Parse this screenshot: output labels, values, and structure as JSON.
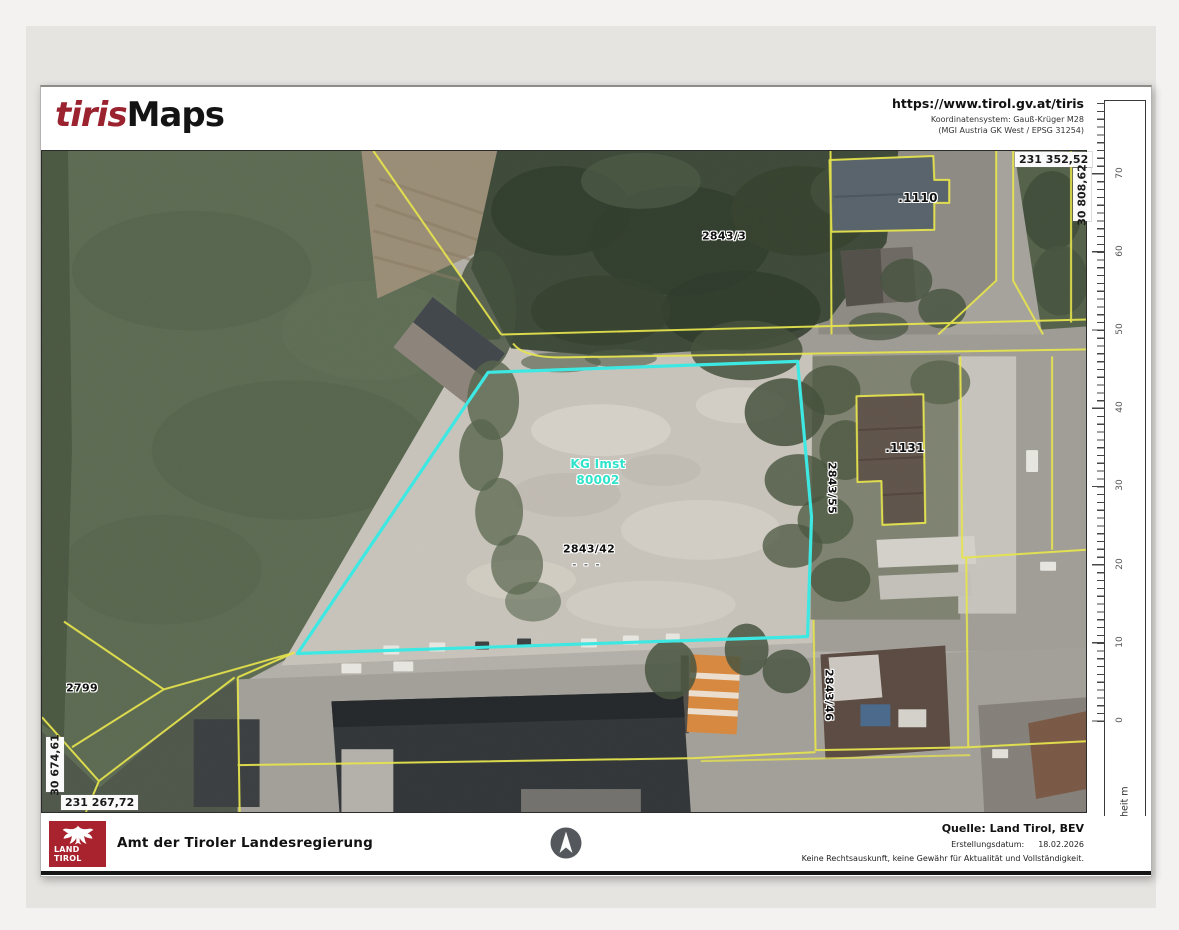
{
  "header": {
    "logo": {
      "part1": "tiris",
      "part2": "Maps"
    },
    "website": "https://www.tirol.gv.at/tiris",
    "coordinate_system_line1": "Koordinatensystem: Gauß-Krüger M28",
    "coordinate_system_line2": "(MGI Austria GK West / EPSG 31254)"
  },
  "map": {
    "corner_coordinates": {
      "top_right_x": "231 352,52",
      "top_right_y": "30 808,62",
      "bottom_left_y": "30 674,61",
      "bottom_left_x": "231 267,72"
    },
    "labels": {
      "parcel_2843_3": "2843/3",
      "building_1110": ".1110",
      "building_1131": ".1131",
      "parcel_2843_55": "2843/55",
      "parcel_2843_42": "2843/42",
      "parcel_2843_42_marks": "- - -",
      "parcel_2843_46": "2843/46",
      "parcel_2799": "2799",
      "cadastral_unit_name": "KG Imst",
      "cadastral_unit_number": "80002"
    },
    "colors": {
      "parcel_boundary_yellow": "#e7e54d",
      "highlight_cyan": "#3ce9e3",
      "kg_label_cyan": "#2fe3cb",
      "brand_red": "#a8232e"
    }
  },
  "scalebar": {
    "tick_labels": [
      "70",
      "60",
      "50",
      "40",
      "30",
      "20",
      "10",
      "0"
    ],
    "unit_label": "Maßeinheit m"
  },
  "footer": {
    "logo_line1": "LAND",
    "logo_line2": "TIROL",
    "agency_name": "Amt der Tiroler Landesregierung",
    "source": "Quelle: Land Tirol, BEV",
    "creation_date_label": "Erstellungsdatum:",
    "creation_date": "18.02.2026",
    "disclaimer": "Keine Rechtsauskunft, keine Gewähr für Aktualität und Vollständigkeit."
  }
}
